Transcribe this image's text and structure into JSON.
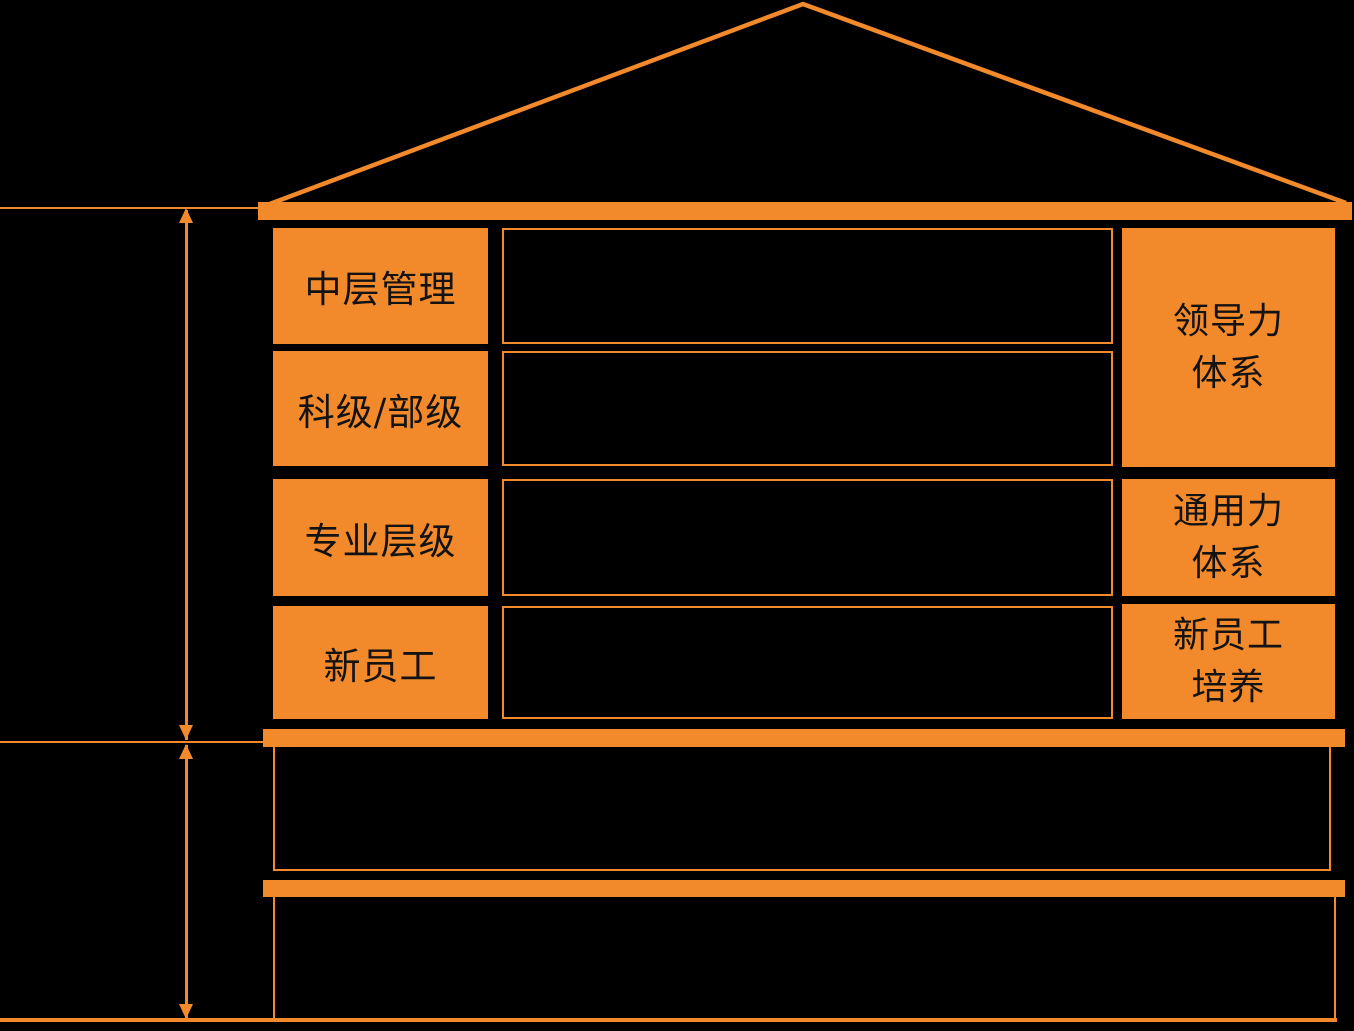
{
  "colors": {
    "accent_orange": "#F28A2B",
    "background": "#000000",
    "box_text": "#131313"
  },
  "house": {
    "levels": [
      {
        "label": "中层管理"
      },
      {
        "label": "科级/部级"
      },
      {
        "label": "专业层级"
      },
      {
        "label": "新员工"
      }
    ],
    "content_rows": [
      {
        "label": ""
      },
      {
        "label": ""
      },
      {
        "label": ""
      },
      {
        "label": ""
      }
    ],
    "systems": [
      {
        "line1": "领导力",
        "line2": "体系"
      },
      {
        "line1": "通用力",
        "line2": "体系"
      },
      {
        "line1": "新员工",
        "line2": "培养"
      }
    ]
  }
}
